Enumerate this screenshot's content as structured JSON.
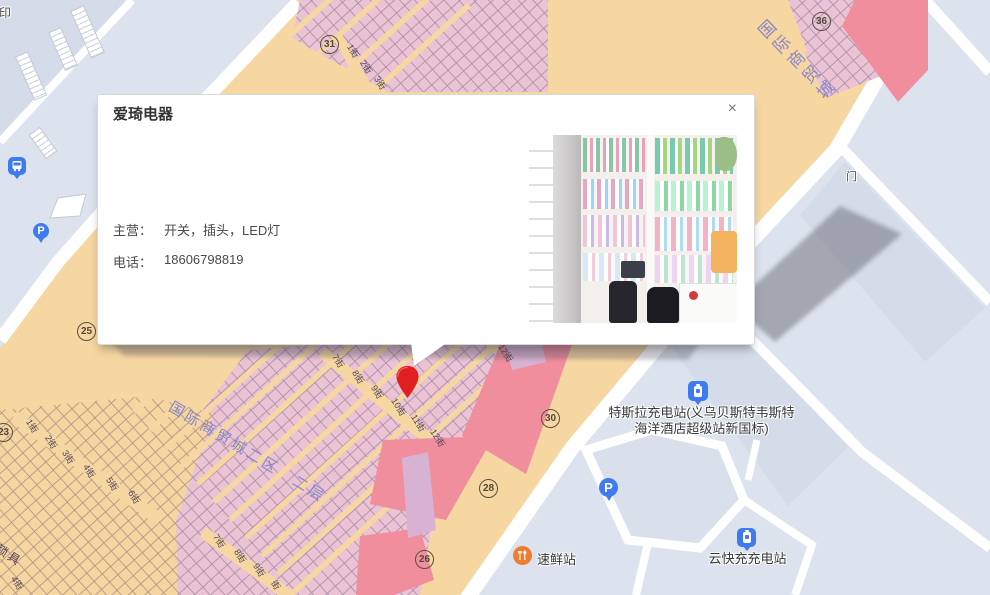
{
  "popup": {
    "title": "爱琦电器",
    "rows": [
      {
        "label": "主营：",
        "value": "开关，插头，LED灯"
      },
      {
        "label": "电话：",
        "value": "18606798819"
      }
    ],
    "close_label": "×",
    "photo_alt": "shop-interior-photo"
  },
  "map": {
    "markers": [
      {
        "n": "31",
        "x": 320,
        "y": 35
      },
      {
        "n": "36",
        "x": 812,
        "y": 12
      },
      {
        "n": "25",
        "x": 77,
        "y": 322
      },
      {
        "n": "23",
        "x": -6,
        "y": 423
      },
      {
        "n": "30",
        "x": 541,
        "y": 409
      },
      {
        "n": "28",
        "x": 479,
        "y": 479
      },
      {
        "n": "26",
        "x": 415,
        "y": 550
      }
    ],
    "street_labels": [
      {
        "t": "1街",
        "x": 346,
        "y": 46
      },
      {
        "t": "2街",
        "x": 359,
        "y": 62
      },
      {
        "t": "3街",
        "x": 373,
        "y": 78
      },
      {
        "t": "7街",
        "x": 331,
        "y": 356
      },
      {
        "t": "8街",
        "x": 351,
        "y": 372
      },
      {
        "t": "9街",
        "x": 370,
        "y": 387
      },
      {
        "t": "10街",
        "x": 389,
        "y": 402
      },
      {
        "t": "11街",
        "x": 409,
        "y": 418
      },
      {
        "t": "12街",
        "x": 428,
        "y": 433
      },
      {
        "t": "街",
        "x": 482,
        "y": 336
      },
      {
        "t": "12街",
        "x": 496,
        "y": 348
      },
      {
        "t": "1街",
        "x": 25,
        "y": 421
      },
      {
        "t": "2街",
        "x": 44,
        "y": 437
      },
      {
        "t": "3街",
        "x": 61,
        "y": 452
      },
      {
        "t": "4街",
        "x": 82,
        "y": 466
      },
      {
        "t": "5街",
        "x": 105,
        "y": 479
      },
      {
        "t": "6街",
        "x": 127,
        "y": 492
      },
      {
        "t": "7街",
        "x": 212,
        "y": 536
      },
      {
        "t": "8街",
        "x": 233,
        "y": 551
      },
      {
        "t": "9街",
        "x": 252,
        "y": 565
      },
      {
        "t": "街",
        "x": 271,
        "y": 580
      },
      {
        "t": "4街",
        "x": 10,
        "y": 578
      }
    ],
    "area_labels": {
      "district": "国际商贸城二区　二层",
      "market": "国际商贸城",
      "lock": "锁具",
      "print": "复印",
      "gate": "门"
    },
    "pois": {
      "tesla": {
        "line1": "特斯拉充电站(义乌贝斯特韦斯特",
        "line2": "海洋酒店超级站新国标)"
      },
      "fresh": {
        "label": "速鲜站"
      },
      "cloud_charge": {
        "label": "云快充充电站"
      }
    },
    "colors": {
      "market_bg": "#F6D7A2",
      "stall_pink": "#EAC3D5",
      "block_red": "#F08E9D",
      "block_lavender": "#D8B2D2",
      "road_area": "#DDE3EE",
      "accent_blue": "#3E7BF0",
      "pin_red": "#E02020",
      "label_purple": "#8A85C8",
      "poi_orange": "#F07C2E"
    }
  }
}
